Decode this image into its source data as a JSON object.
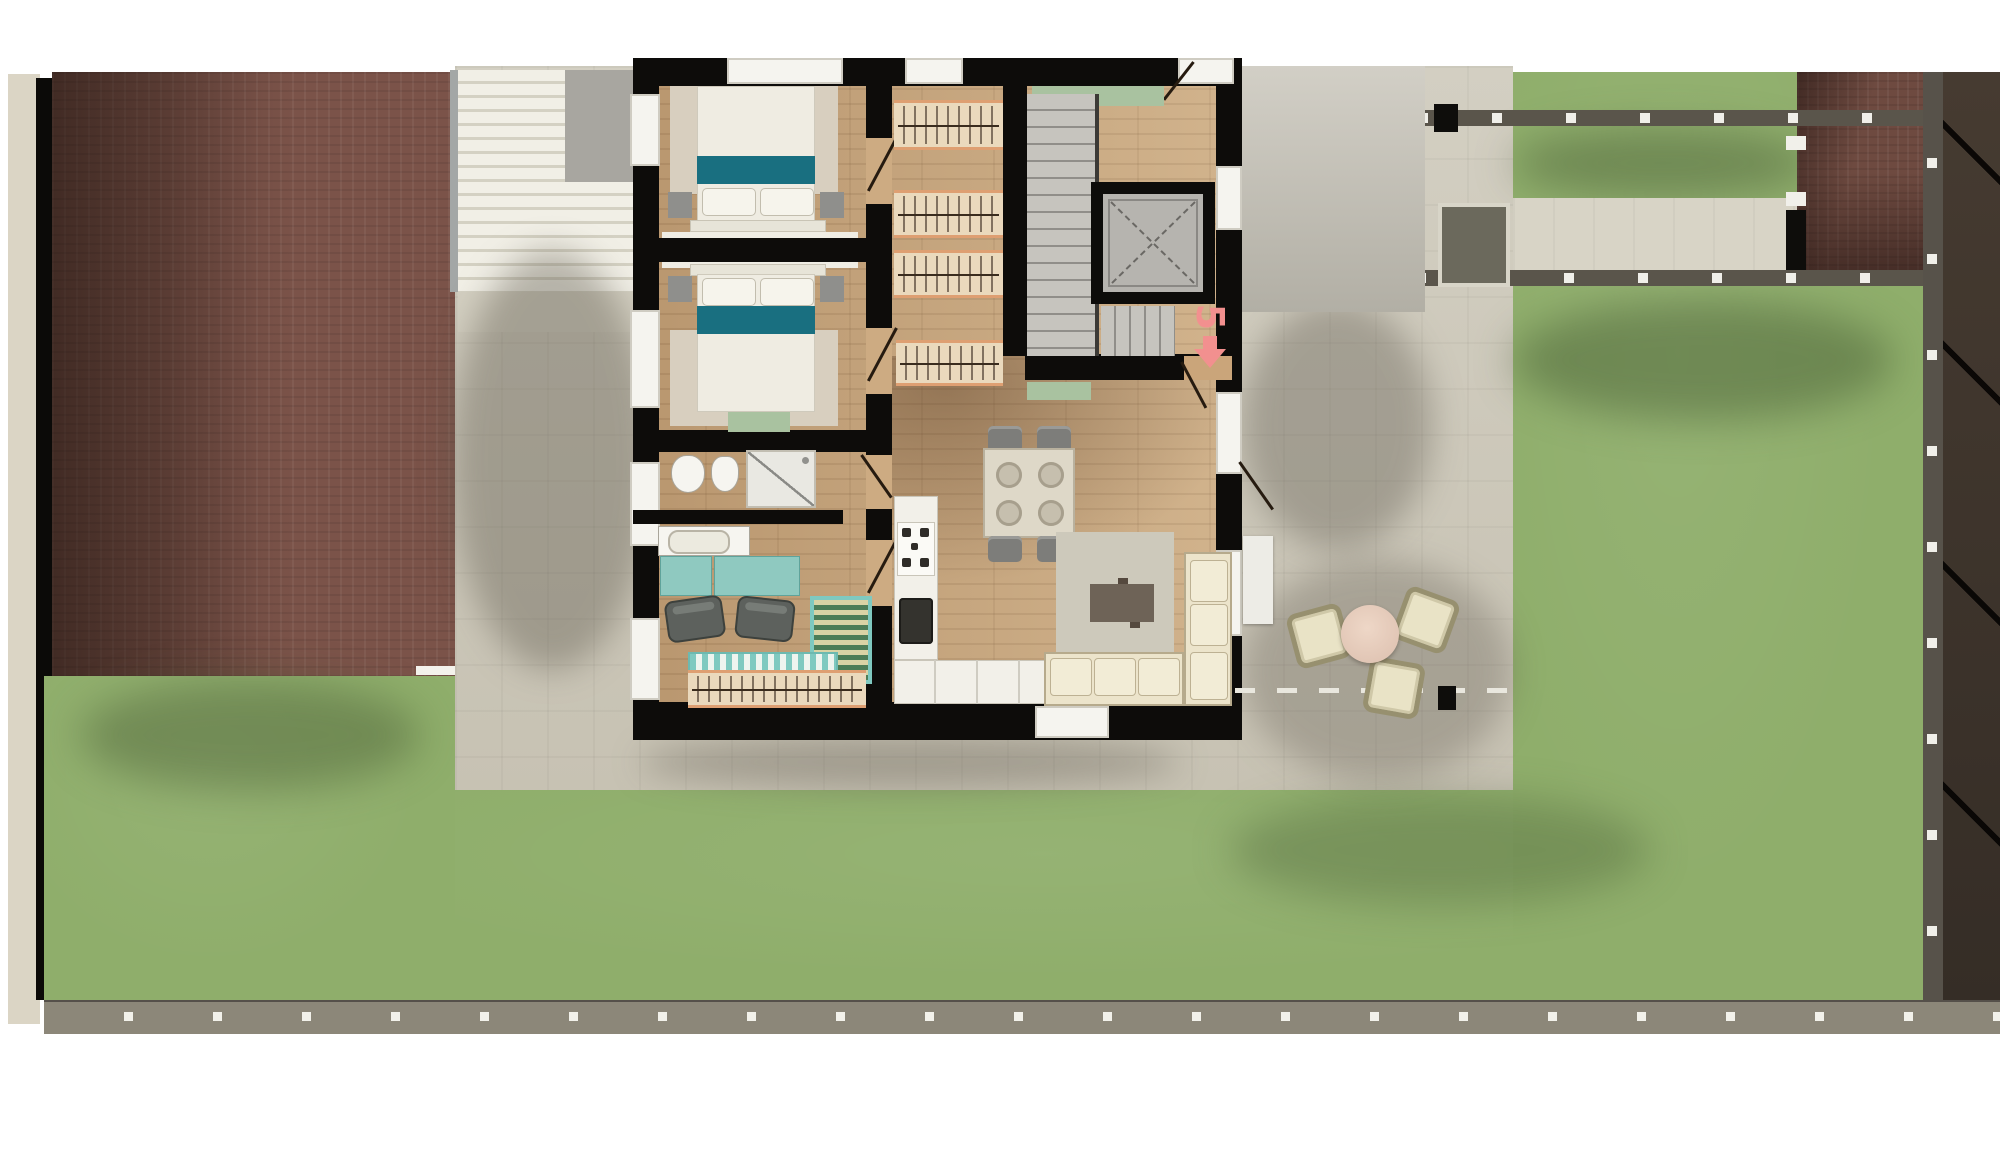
{
  "plan": {
    "type": "apartment-site-plan-top-view",
    "unit_marker": {
      "label": "5",
      "color": "#f2908f",
      "direction": "down"
    }
  },
  "palette": {
    "grass": "#8fae6b",
    "brick_paving_left": "#7b5349",
    "brick_paving_right": "#6e4a40",
    "roof_dark": "#3a322b",
    "apron_paving": "#ccc7b8",
    "path": "#d8d4c6",
    "wall_black": "#0d0c0a",
    "wood_floor": "#c9a87f",
    "bed_accent_teal": "#196f80",
    "desk_teal": "#8fc9c0",
    "sofa_cream": "#ece4cb",
    "fence_gray": "#5a554b",
    "marker_pink": "#f2908f",
    "green_mat": "#a9c2a0"
  },
  "rooms": [
    "bedroom-1",
    "bedroom-2",
    "bathroom",
    "study",
    "kitchen",
    "living-dining",
    "entry-hall",
    "stair-core"
  ],
  "furniture": [
    "double-bed",
    "double-bed",
    "nightstand",
    "nightstand",
    "nightstand",
    "nightstand",
    "wardrobe-closet",
    "wardrobe-closet",
    "wardrobe-closet",
    "wardrobe-closet",
    "wardrobe-row",
    "toilet",
    "bidet",
    "shower",
    "bathtub",
    "desk",
    "desk",
    "office-chair",
    "office-chair",
    "kitchen-counter",
    "stove",
    "kitchen-sink",
    "dining-table",
    "dining-chair",
    "dining-chair",
    "dining-chair",
    "dining-chair",
    "rug",
    "coffee-table",
    "corner-sofa",
    "outdoor-round-table",
    "outdoor-chair",
    "outdoor-chair",
    "outdoor-chair",
    "elevator",
    "staircase",
    "striped-rug",
    "teal-bench",
    "doormat"
  ]
}
